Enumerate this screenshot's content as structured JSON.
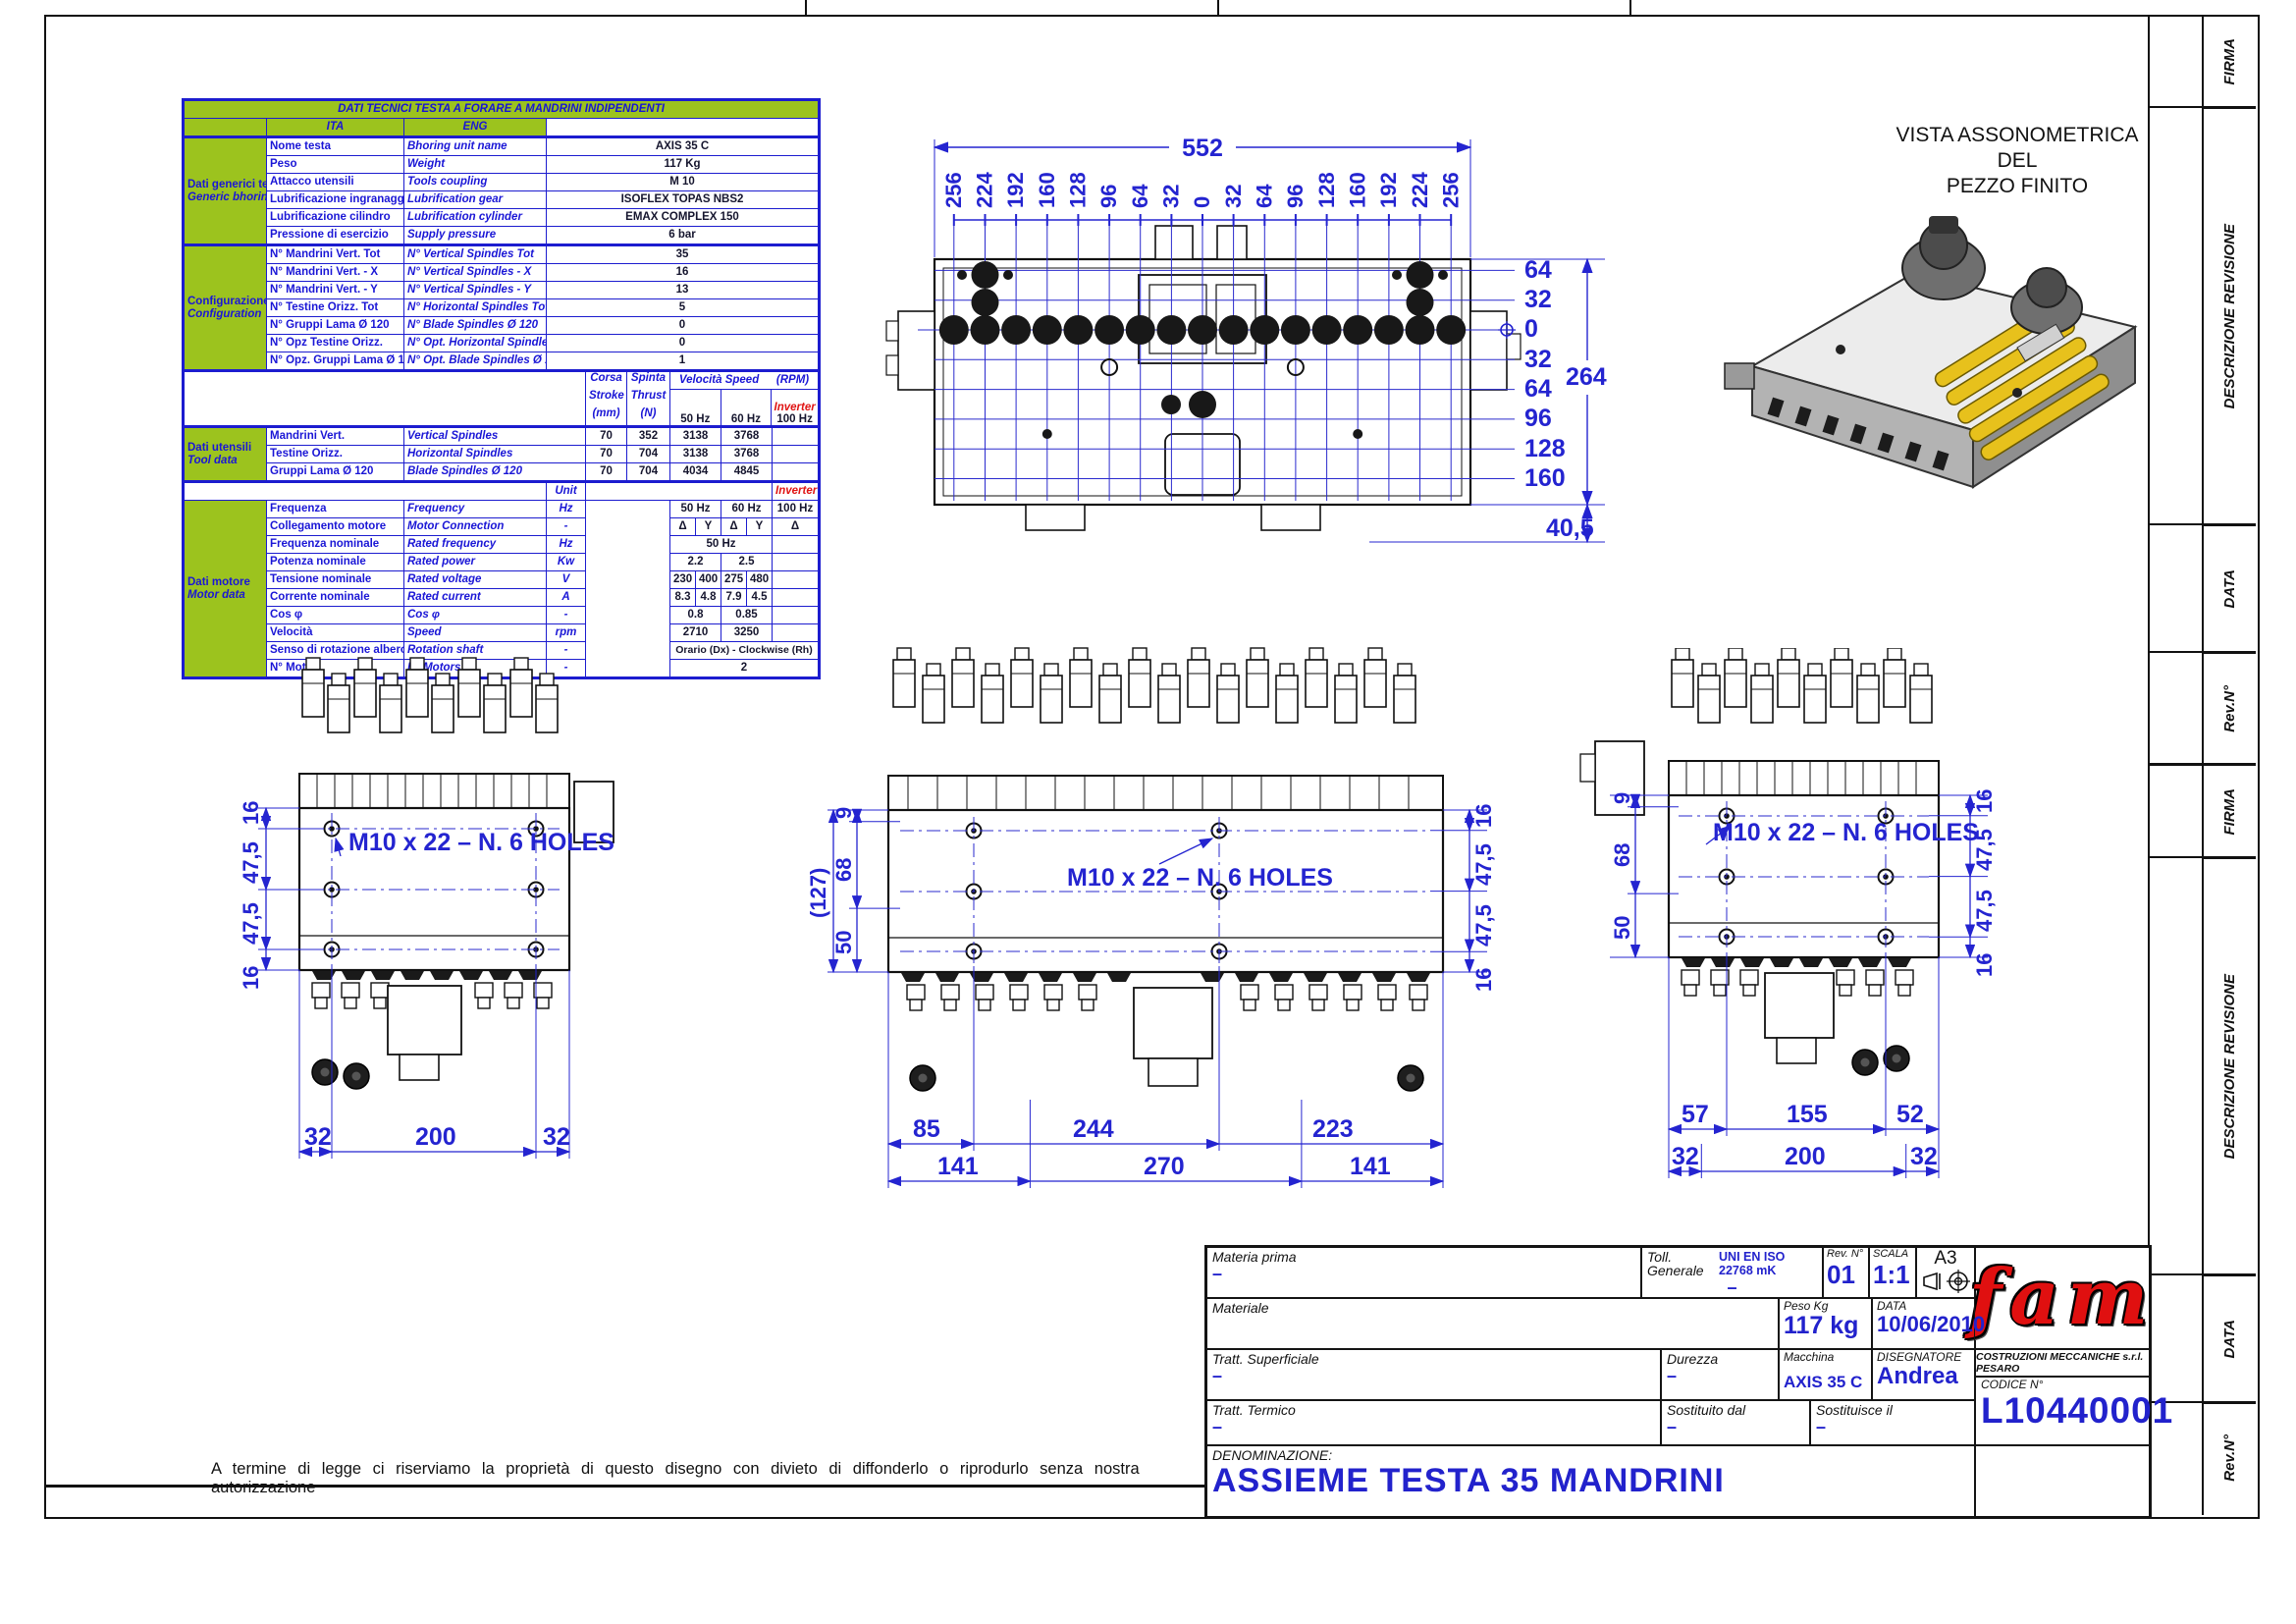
{
  "table": {
    "title": "DATI TECNICI TESTA A FORARE A MANDRINI INDIPENDENTI",
    "headers": {
      "ita": "ITA",
      "eng": "ENG"
    },
    "sections": {
      "generic": {
        "ita": "Dati generici testa",
        "eng": "Generic bhoring unit data"
      },
      "config": {
        "ita": "Configurazione",
        "eng": "Configuration"
      },
      "tool": {
        "ita": "Dati utensili",
        "eng": "Tool data"
      },
      "motor": {
        "ita": "Dati motore",
        "eng": "Motor data"
      }
    },
    "generic_rows": [
      {
        "ita": "Nome testa",
        "eng": "Bhoring unit name",
        "value": "AXIS 35 C"
      },
      {
        "ita": "Peso",
        "eng": "Weight",
        "value": "117 Kg"
      },
      {
        "ita": "Attacco utensili",
        "eng": "Tools coupling",
        "value": "M 10"
      },
      {
        "ita": "Lubrificazione ingranaggi",
        "eng": "Lubrification gear",
        "value": "ISOFLEX TOPAS NBS2"
      },
      {
        "ita": "Lubrificazione cilindro",
        "eng": "Lubrification cylinder",
        "value": "EMAX COMPLEX 150"
      },
      {
        "ita": "Pressione di esercizio",
        "eng": "Supply pressure",
        "value": "6 bar"
      }
    ],
    "config_rows": [
      {
        "ita": "N° Mandrini Vert. Tot",
        "eng": "N° Vertical Spindles Tot",
        "value": "35"
      },
      {
        "ita": "N° Mandrini Vert. - X",
        "eng": "N° Vertical Spindles - X",
        "value": "16"
      },
      {
        "ita": "N° Mandrini Vert. - Y",
        "eng": "N° Vertical Spindles - Y",
        "value": "13"
      },
      {
        "ita": "N° Testine Orizz. Tot",
        "eng": "N° Horizontal Spindles Tot",
        "value": "5"
      },
      {
        "ita": "N° Gruppi Lama Ø 120",
        "eng": "N° Blade Spindles Ø 120",
        "value": "0"
      },
      {
        "ita": "N° Opz Testine Orizz.",
        "eng": "N° Opt. Horizontal Spindles",
        "value": "0"
      },
      {
        "ita": "N° Opz. Gruppi Lama Ø 120",
        "eng": "N° Opt. Blade Spindles Ø 120",
        "value": "1"
      }
    ],
    "tool_header": {
      "corsa": "Corsa",
      "stroke": "Stroke",
      "mm": "(mm)",
      "spinta": "Spinta",
      "thrust": "Thrust",
      "n": "(N)",
      "speed": "Velocità Speed",
      "rpm": "(RPM)",
      "hz50": "50 Hz",
      "hz60": "60 Hz",
      "inverter": "Inverter",
      "hz100": "100 Hz"
    },
    "tool_rows": [
      {
        "ita": "Mandrini Vert.",
        "eng": "Vertical Spindles",
        "stroke": "70",
        "thrust": "352",
        "hz50": "3138",
        "hz60": "3768"
      },
      {
        "ita": "Testine Orizz.",
        "eng": "Horizontal Spindles",
        "stroke": "70",
        "thrust": "704",
        "hz50": "3138",
        "hz60": "3768"
      },
      {
        "ita": "Gruppi Lama Ø 120",
        "eng": "Blade Spindles Ø 120",
        "stroke": "70",
        "thrust": "704",
        "hz50": "4034",
        "hz60": "4845"
      }
    ],
    "unit_label": "Unit",
    "inverter_label": "Inverter",
    "motor_rows": [
      {
        "ita": "Frequenza",
        "eng": "Frequency",
        "unit": "Hz",
        "v": [
          "50 Hz",
          "60 Hz",
          "100 Hz"
        ]
      },
      {
        "ita": "Collegamento motore",
        "eng": "Motor Connection",
        "unit": "-",
        "v": [
          "Δ",
          "Y",
          "Δ",
          "Y",
          "Δ"
        ]
      },
      {
        "ita": "Frequenza nominale",
        "eng": "Rated frequency",
        "unit": "Hz",
        "v": [
          "50 Hz"
        ]
      },
      {
        "ita": "Potenza nominale",
        "eng": "Rated power",
        "unit": "Kw",
        "v": [
          "2.2",
          "2.5"
        ]
      },
      {
        "ita": "Tensione nominale",
        "eng": "Rated voltage",
        "unit": "V",
        "v": [
          "230",
          "400",
          "275",
          "480"
        ]
      },
      {
        "ita": "Corrente nominale",
        "eng": "Rated current",
        "unit": "A",
        "v": [
          "8.3",
          "4.8",
          "7.9",
          "4.5"
        ]
      },
      {
        "ita": "Cos φ",
        "eng": "Cos φ",
        "unit": "-",
        "v": [
          "0.8",
          "0.85"
        ]
      },
      {
        "ita": "Velocità",
        "eng": "Speed",
        "unit": "rpm",
        "v": [
          "2710",
          "3250"
        ]
      },
      {
        "ita": "Senso di rotazione albero",
        "eng": "Rotation shaft",
        "unit": "-",
        "v": [
          "Orario (Dx) - Clockwise (Rh)"
        ]
      },
      {
        "ita": "N° Motori",
        "eng": "N° Motors",
        "unit": "-",
        "v": [
          "2"
        ]
      }
    ]
  },
  "top_view": {
    "width_dim": "552",
    "xticks": [
      "256",
      "224",
      "192",
      "160",
      "128",
      "96",
      "64",
      "32",
      "0",
      "32",
      "64",
      "96",
      "128",
      "160",
      "192",
      "224",
      "256"
    ],
    "yticks": [
      "64",
      "32",
      "0",
      "32",
      "64",
      "96",
      "128",
      "160"
    ],
    "height_dim": "264",
    "offset_dim": "40,5"
  },
  "iso_view": {
    "caption_l1": "VISTA ASSONOMETRICA",
    "caption_l2": "DEL",
    "caption_l3": "PEZZO FINITO"
  },
  "front_views": {
    "holes_label": "M10   x  22 – N. 6 HOLES",
    "left": {
      "vdims": [
        "16",
        "47,5",
        "47,5",
        "16"
      ],
      "bottom2": [
        "32",
        "200",
        "32"
      ]
    },
    "middle": {
      "vdims_left": [
        "9",
        "68",
        "50"
      ],
      "overall": "(127)",
      "vdims_right": [
        "16",
        "47,5",
        "47,5",
        "16"
      ],
      "bottom1": [
        "85",
        "244",
        "223"
      ],
      "bottom2": [
        "141",
        "270",
        "141"
      ]
    },
    "right": {
      "vdims_left": [
        "9",
        "68",
        "50"
      ],
      "vdims_right": [
        "16",
        "47,5",
        "47,5",
        "16"
      ],
      "bottom1": [
        "57",
        "155",
        "52"
      ],
      "bottom2": [
        "32",
        "200",
        "32"
      ]
    }
  },
  "revision_strip": {
    "firma": "FIRMA",
    "descrizione": "DESCRIZIONE REVISIONE",
    "data": "DATA",
    "rev": "Rev.N°"
  },
  "title_block": {
    "materia_prima_label": "Materia prima",
    "materia_prima": "–",
    "materiale_label": "Materiale",
    "tratt_sup_label": "Tratt. Superficiale",
    "tratt_sup": "–",
    "tratt_term_label": "Tratt. Termico",
    "tratt_term": "–",
    "toll_label": "Toll. Generale",
    "toll_value": "UNI EN ISO 22768 mK",
    "toll_dash": "–",
    "rev_label": "Rev. N°",
    "rev": "01",
    "scala_label": "SCALA",
    "scala": "1:1",
    "format": "A3",
    "peso_label": "Peso Kg",
    "peso": "117 kg",
    "data_label": "DATA",
    "data": "10/06/2010",
    "durezza_label": "Durezza",
    "durezza": "–",
    "macchina_label": "Macchina",
    "macchina": "AXIS 35 C",
    "disegnatore_label": "DISEGNATORE",
    "disegnatore": "Andrea",
    "sostituito_label": "Sostituito dal",
    "sostituito": "–",
    "sostituisce_label": "Sostituisce il",
    "sostituisce": "–",
    "logo": "fam",
    "company": "COSTRUZIONI MECCANICHE s.r.l. PESARO",
    "codice_label": "CODICE N°",
    "codice": "L10440001",
    "denominazione_label": "DENOMINAZIONE:",
    "denominazione": "ASSIEME TESTA 35 MANDRINI"
  },
  "disclaimer": "A termine di legge ci riserviamo la proprietà di questo disegno con divieto di diffonderlo o riprodurlo senza nostra autorizzazione"
}
